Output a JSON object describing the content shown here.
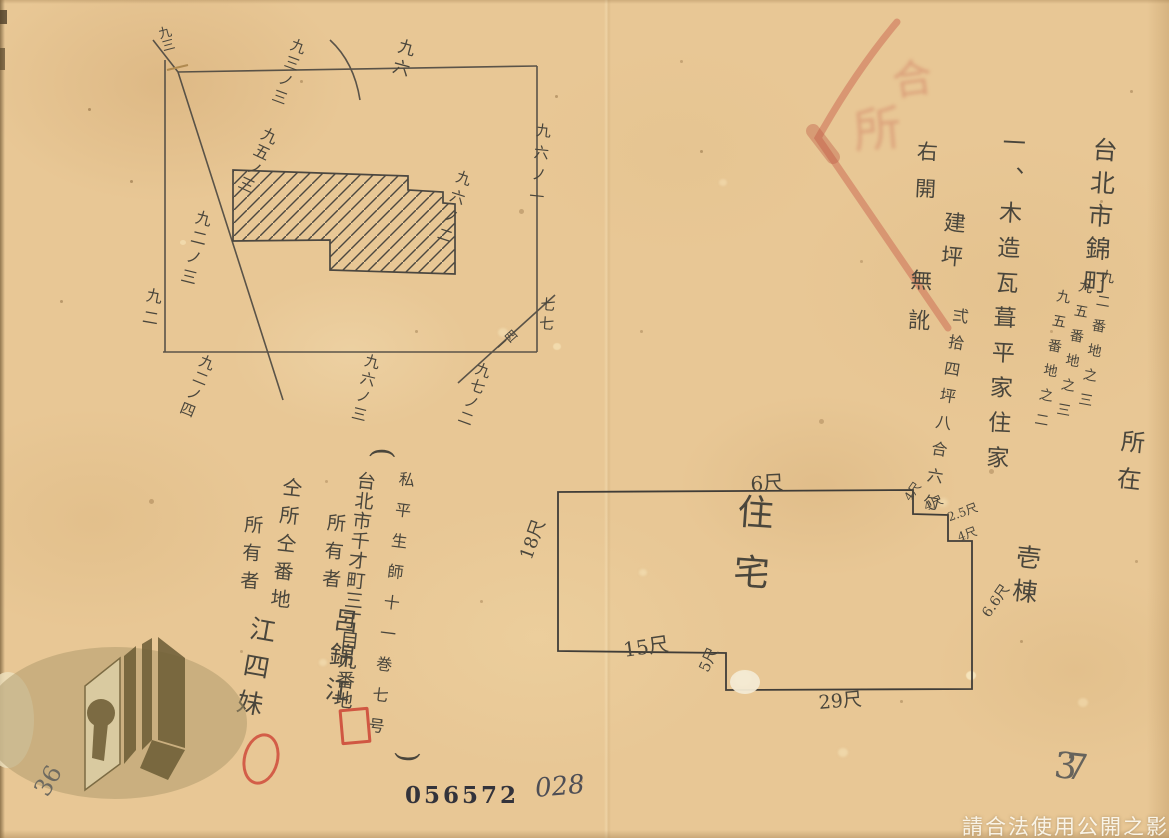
{
  "page": {
    "paper_color": "#e8c795",
    "ink_color": "#4a463c",
    "red_color": "#c9503c"
  },
  "survey_map": {
    "labels": {
      "corner": "九三",
      "arc": "九三ノ三",
      "top": "九六",
      "right1": "九六ノ一",
      "right2": "九六ノ二",
      "building": "九五ノ三",
      "left": "九二",
      "left_diag": "九二ノ三",
      "bottom1": "九二ノ四",
      "bottom2": "九六ノ三",
      "bottom3": "九七ノ二",
      "corner_small": "一四",
      "right_edge": "七七"
    }
  },
  "property_text": {
    "location": "台北市錦町",
    "lot1": "九二番地之三",
    "lot2": "九五番地之三",
    "lot3": "九五番地之二",
    "suffix": "所在",
    "building": "一、木造瓦葺平家住家",
    "count": "壱棟",
    "area_label": "建坪",
    "area": "弍拾四坪八合六勺",
    "closing1": "右開",
    "closing2": "無訛"
  },
  "red_stamp": {
    "mark1": "合",
    "mark2": "所"
  },
  "floor_plan": {
    "room": "住宅",
    "dim_top": "6尺",
    "dim_left": "18尺",
    "dim_notch1_v": "4尺",
    "dim_notch1_h": "4尺",
    "dim_notch2_v": "2.5尺",
    "dim_notch2_h": "4尺",
    "dim_right": "6.6尺",
    "dim_bottom_left": "15尺",
    "dim_step": "5尺",
    "dim_bottom": "29尺"
  },
  "owners": {
    "ref_open": "(",
    "ref": "私平生師十一巻七号",
    "ref_close": ")",
    "addr1": "台北市千才町三丁目九番地",
    "label1": "所有者",
    "name1": "呂錦江",
    "addr2": "仝所仝番地",
    "label2": "所有者",
    "name2": "江四妹"
  },
  "marks": {
    "serial": "056572",
    "page": "028",
    "pencil_left": "36",
    "pencil_right": "37"
  },
  "watermark": {
    "notice": "請合法使用公開之影像"
  }
}
